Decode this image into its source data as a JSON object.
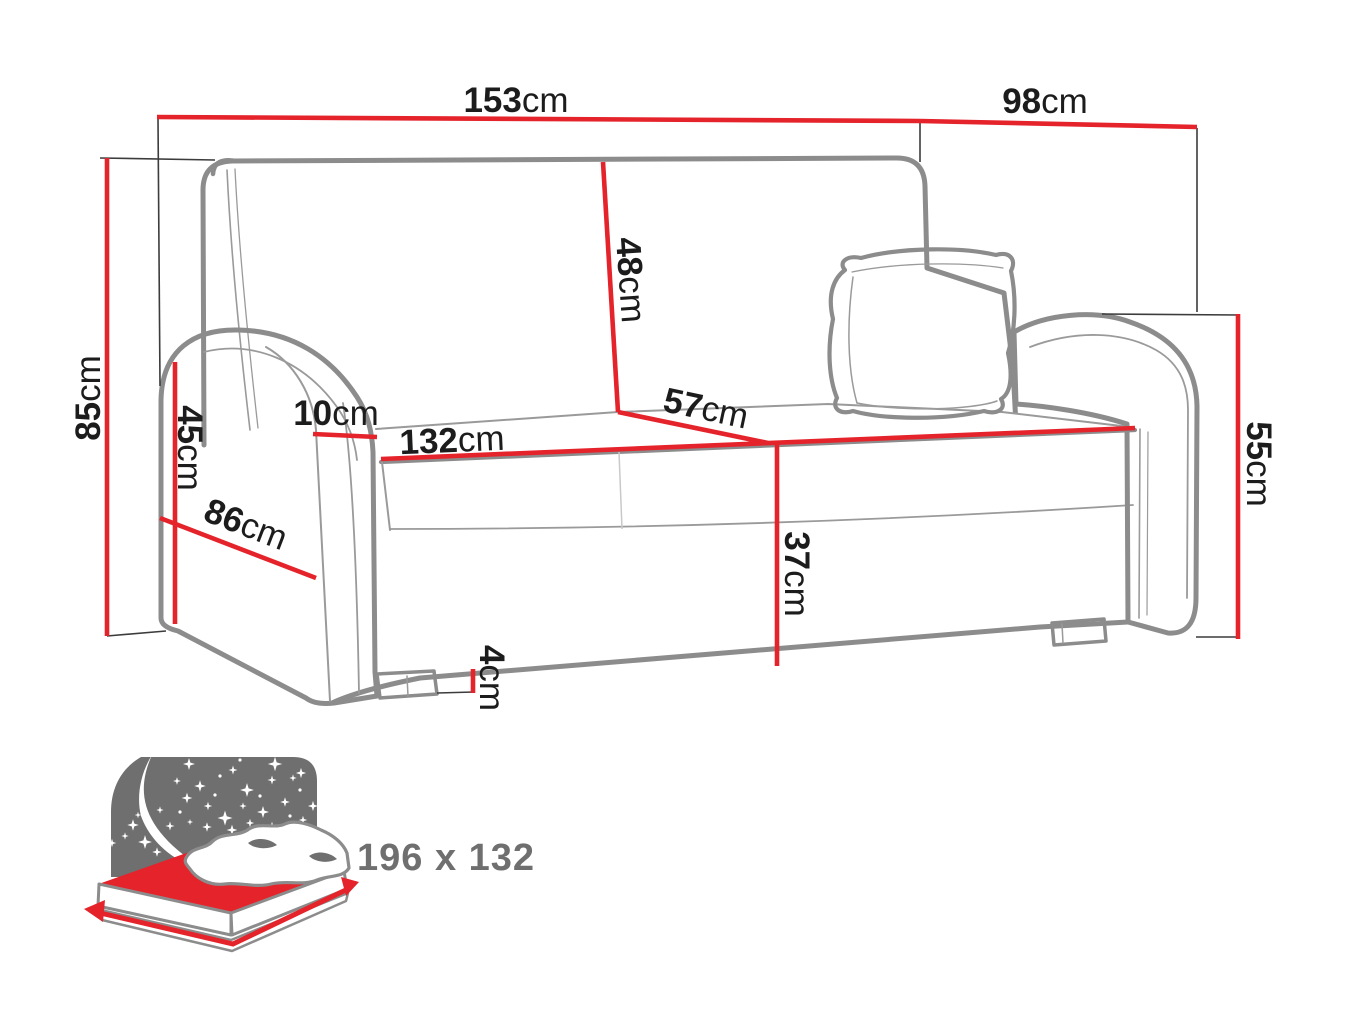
{
  "diagram": {
    "subject": "sofa-dimensions-diagram",
    "unit": "cm",
    "dimensions": {
      "overall_width": {
        "value": "153",
        "unit": "cm"
      },
      "overall_depth": {
        "value": "98",
        "unit": "cm"
      },
      "overall_height": {
        "value": "85",
        "unit": "cm"
      },
      "armrest_front_height": {
        "value": "45",
        "unit": "cm"
      },
      "armrest_width": {
        "value": "10",
        "unit": "cm"
      },
      "armrest_side_depth": {
        "value": "86",
        "unit": "cm"
      },
      "backrest_height": {
        "value": "48",
        "unit": "cm"
      },
      "seat_depth": {
        "value": "57",
        "unit": "cm"
      },
      "seat_width": {
        "value": "132",
        "unit": "cm"
      },
      "seat_height": {
        "value": "37",
        "unit": "cm"
      },
      "leg_height": {
        "value": "4",
        "unit": "cm"
      },
      "armrest_outer_height": {
        "value": "55",
        "unit": "cm"
      }
    },
    "sleeping_area": {
      "label": "196 x 132"
    },
    "icons": {
      "sleep_function": "bed-with-night-sky-icon"
    },
    "colors": {
      "dimension_line_red": "#e5232b",
      "sofa_outline_gray": "#8c8c8c",
      "icon_gray": "#6f6f6f",
      "label_text": "#1c1c1c",
      "background": "#ffffff"
    }
  }
}
